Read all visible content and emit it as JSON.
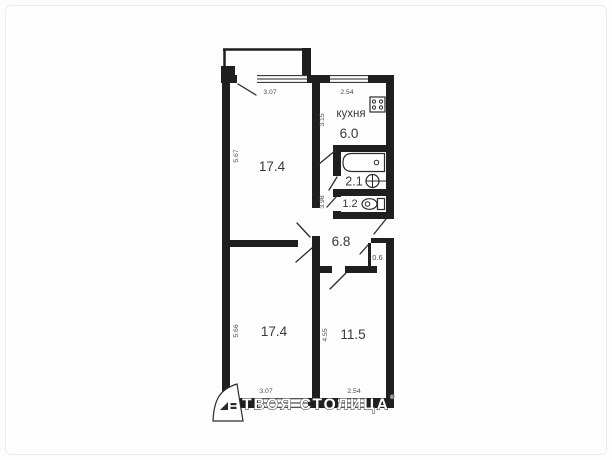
{
  "plan": {
    "rooms": [
      {
        "id": "kitchen",
        "name": "кухня",
        "area": "6.0"
      },
      {
        "id": "room-top",
        "name": "",
        "area": "17.4"
      },
      {
        "id": "bathroom",
        "name": "",
        "area": "2.1"
      },
      {
        "id": "toilet",
        "name": "",
        "area": "1.2"
      },
      {
        "id": "hallway",
        "name": "",
        "area": "6.8"
      },
      {
        "id": "room-bottom",
        "name": "",
        "area": "17.4"
      },
      {
        "id": "room-right",
        "name": "",
        "area": "11.5"
      }
    ],
    "dimensions": {
      "top_room_width": "3.07",
      "kitchen_width": "2.54",
      "top_room_height": "5.67",
      "kitchen_height": "3.15",
      "hall_height": "3.98",
      "bottom_room_height": "5.66",
      "right_room_height": "4.55",
      "bottom_room_width": "3.07",
      "right_room_width": "2.54",
      "niche_width": "0.6"
    },
    "watermark": {
      "text": "ТВОЯ СТОЛИЦА",
      "reg": "®"
    },
    "colors": {
      "wall": "#1f1f1f",
      "room_label": "#3a3a3a",
      "dimension_label": "#4d4d4d",
      "background": "#fdfdfd"
    }
  }
}
